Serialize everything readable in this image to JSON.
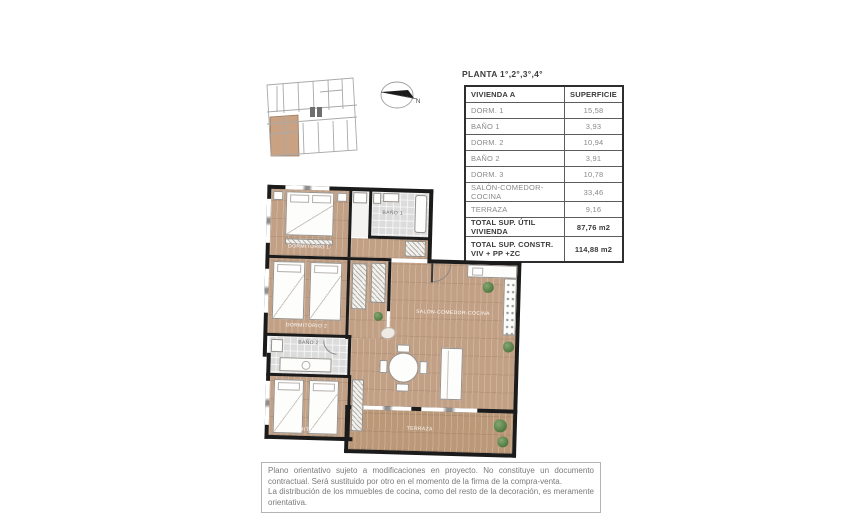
{
  "table": {
    "title": "PLANTA 1°,2°,3°,4°",
    "headers": {
      "name": "VIVIENDA A",
      "area": "SUPERFICIE"
    },
    "rows": [
      {
        "label": "DORM. 1",
        "value": "15,58"
      },
      {
        "label": "BAÑO 1",
        "value": "3,93"
      },
      {
        "label": "DORM. 2",
        "value": "10,94"
      },
      {
        "label": "BAÑO 2",
        "value": "3,91"
      },
      {
        "label": "DORM. 3",
        "value": "10,78"
      },
      {
        "label": "SALÓN-COMEDOR-COCINA",
        "value": "33,46"
      },
      {
        "label": "TERRAZA",
        "value": "9,16"
      }
    ],
    "totals": [
      {
        "label": "TOTAL SUP. ÚTIL VIVIENDA",
        "value": "87,76 m2"
      },
      {
        "label_line1": "TOTAL SUP. CONSTR.",
        "label_line2": "VIV + PP +ZC",
        "value": "114,88 m2"
      }
    ]
  },
  "compass": {
    "north_label": "N"
  },
  "plan": {
    "rooms": {
      "dorm1": "DORMITORIO 1",
      "bano1": "BAÑO 1",
      "dorm2": "DORMITORIO 2",
      "bano2": "BAÑO 2",
      "dorm3": "DORMITORIO 3",
      "salon": "SALÓN-COMEDOR-COCINA",
      "terraza": "TERRAZA"
    }
  },
  "disclaimer": {
    "lines": [
      "Plano orientativo sujeto a modificaciones en proyecto. No constituye un documento contractual. Será sustituido por otro en el momento de la firma de la compra-venta.",
      "La distribución de los mmuebles de cocina, como del resto de la decoración, es meramente orientativa."
    ]
  },
  "colors": {
    "wood": "#c2a085",
    "bath_tile": "#dcdcdc",
    "wall": "#1b1b1b",
    "unit_highlight": "#c9a183",
    "table_text": "#8a8a8a",
    "heading_text": "#3c3c3c"
  }
}
